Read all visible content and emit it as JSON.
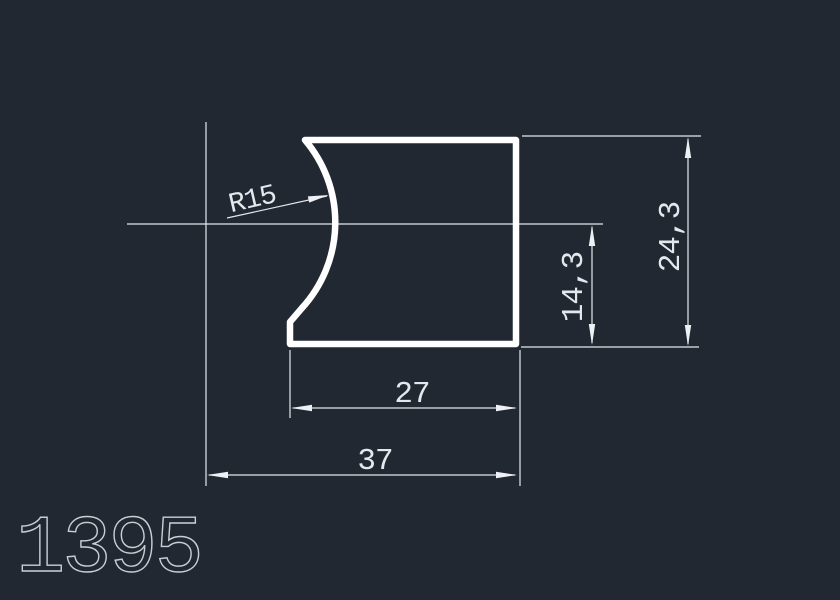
{
  "drawing": {
    "part_number": "1395",
    "labels": {
      "radius": "R15",
      "overall_height": "24,3",
      "step_height": "14,3",
      "inner_width": "27",
      "overall_width": "37"
    },
    "colors": {
      "background": "#212832",
      "profile_stroke": "#ffffff",
      "annotation": "#e4e8ec",
      "part_number": "#c9ced4"
    }
  }
}
